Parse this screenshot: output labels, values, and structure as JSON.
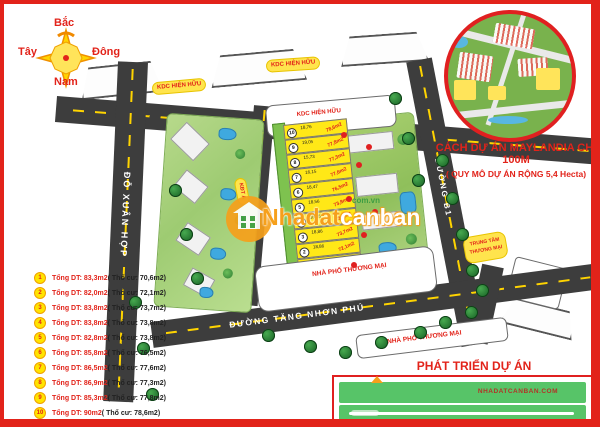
{
  "compass": {
    "north": "Bắc",
    "east": "Đông",
    "west": "Tây",
    "south": "Nam"
  },
  "inset": {
    "caption_line1": "CÁCH DỰ ÁN MAYLANDIA CHỈ 100M",
    "caption_line2": "( QUY MÔ DỰ ÁN RỘNG 5,4 Hecta)"
  },
  "map": {
    "roads": {
      "do_xuan_hop": "ĐỖ XUÂN HỢP",
      "duong_b1": "ĐƯỜNG B1",
      "tang_nhon_phu": "ĐƯỜNG TĂNG NHƠN PHÚ"
    },
    "labels": {
      "kdc_1": "KDC HIỆN HỮU",
      "kdc_2": "KDC HIỆN HỮU",
      "kdc_3": "KDC HIỆN HỮU",
      "kdt_banner": "KĐT A",
      "nha_pho_tren": "NHÀ PHỐ THƯƠNG MẠI",
      "nha_pho_duoi": "NHÀ PHỐ THƯƠNG MẠI",
      "trung_tam_line1": "TRUNG TÂM",
      "trung_tam_line2": "THƯƠNG MẠI"
    }
  },
  "plots": [
    {
      "no": "10",
      "dim": "18,76",
      "area": "78,6m2"
    },
    {
      "no": "9",
      "dim": "19,05",
      "area": "77,8m2"
    },
    {
      "no": "8",
      "dim": "15,73",
      "area": "77,3m2"
    },
    {
      "no": "7",
      "dim": "16,15",
      "area": "77,6m2"
    },
    {
      "no": "6",
      "dim": "18,47",
      "area": "76,5m2"
    },
    {
      "no": "5",
      "dim": "18,56",
      "area": "73,8m2"
    },
    {
      "no": "4",
      "dim": "16,85",
      "area": "73,8m2"
    },
    {
      "no": "3",
      "dim": "18,86",
      "area": "73,7m2"
    },
    {
      "no": "2",
      "dim": "18,86",
      "area": "72,1m2"
    },
    {
      "no": "1",
      "dim": "17,8",
      "area": "70,6m2"
    }
  ],
  "legend": {
    "items": [
      {
        "no": "1",
        "red": "Tổng DT: 83,3m2",
        "black": "( Thổ cư: 70,6m2)"
      },
      {
        "no": "2",
        "red": "Tổng DT: 82,0m2",
        "black": "( Thổ cư: 72,1m2)"
      },
      {
        "no": "3",
        "red": "Tổng DT: 83,8m2",
        "black": "( Thổ cư: 73,7m2)"
      },
      {
        "no": "4",
        "red": "Tổng DT: 83,8m2",
        "black": "( Thổ cư: 73,8m2)"
      },
      {
        "no": "5",
        "red": "Tổng DT: 82,8m2",
        "black": "( Thổ cư: 73,8m2)"
      },
      {
        "no": "6",
        "red": "Tổng DT: 85,8m2",
        "black": "( Thổ cư: 76,5m2)"
      },
      {
        "no": "7",
        "red": "Tổng DT: 86,5m2",
        "black": "( Thổ cư: 77,6m2)"
      },
      {
        "no": "8",
        "red": "Tổng DT: 86,9m2",
        "black": "( Thổ cư: 77,3m2)"
      },
      {
        "no": "9",
        "red": "Tổng DT: 85,3m2",
        "black": "( Thổ cư: 77,8m2)"
      },
      {
        "no": "10",
        "red": "Tổng DT: 90m2",
        "black": "( Thổ cư: 78,6m2)"
      }
    ]
  },
  "watermark": {
    "brand_part1": "Nhadat",
    "brand_part2": "canban",
    "domain": "com.vn"
  },
  "development": {
    "title": "PHÁT TRIỂN DỰ ÁN",
    "bar1_text": "NHADATCANBAN.COM"
  },
  "colors": {
    "accent_red": "#e2231a",
    "plot_yellow": "#ffe817",
    "road_gray": "#3d3d3d",
    "bar_green": "#57c468"
  }
}
